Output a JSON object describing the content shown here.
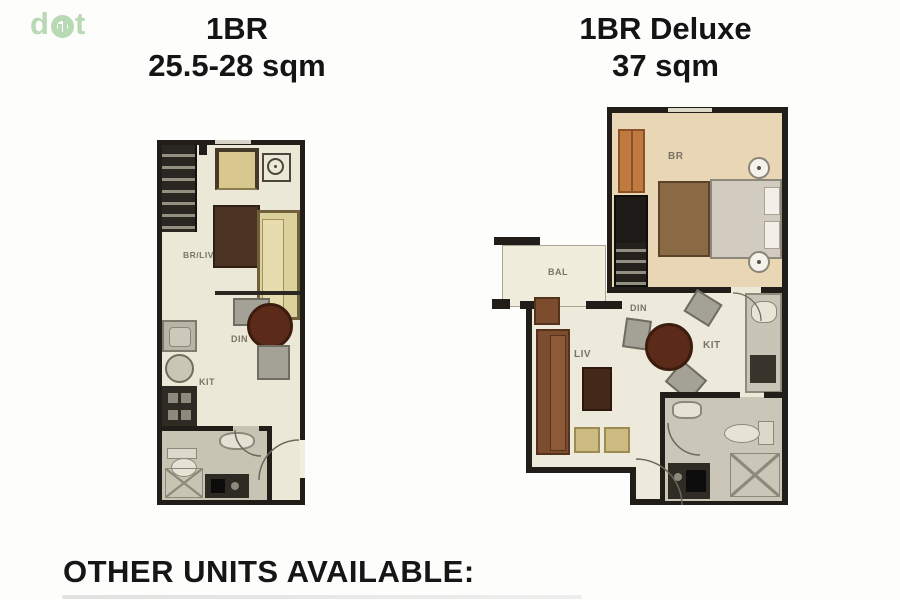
{
  "logo": {
    "d": "d",
    "t": "t"
  },
  "units": [
    {
      "title": "1BR",
      "area": "25.5-28 sqm",
      "labels": {
        "main": "BR/LIV",
        "dining": "DIN",
        "kitchen": "KIT"
      }
    },
    {
      "title": "1BR Deluxe",
      "area": "37 sqm",
      "labels": {
        "bedroom": "BR",
        "balcony": "BAL",
        "living": "LIV",
        "dining": "DIN",
        "kitchen": "KIT"
      }
    }
  ],
  "footer": {
    "heading": "OTHER UNITS AVAILABLE:"
  },
  "colors": {
    "logo_green": "#b7d9b3",
    "wall_black": "#211e19",
    "floor_cream": "#ebe8d8",
    "bedroom_floor_tan": "#e9d6b4",
    "bath_floor_gray": "#c8c4b4",
    "sofa_tan": "#dcd09c",
    "sofa_brown": "#7c4c2e",
    "table_brown": "#5c2a18",
    "wardrobe_orange": "#c0793f",
    "chair_gray": "#a4a197"
  }
}
